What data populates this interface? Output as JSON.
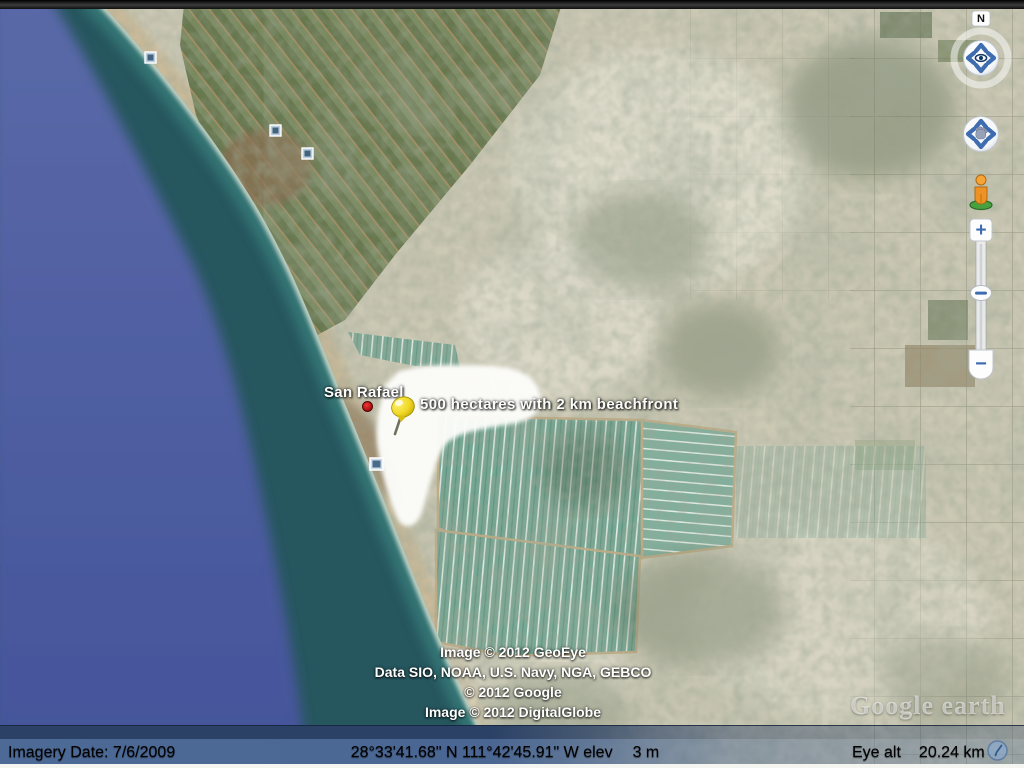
{
  "map": {
    "place": {
      "label": "San Rafael"
    },
    "property": {
      "label": "500 hectares with 2 km beachfront"
    },
    "attribution": [
      "Image © 2012 GeoEye",
      "Data SIO, NOAA, U.S. Navy, NGA, GEBCO",
      "© 2012 Google",
      "Image © 2012 DigitalGlobe"
    ],
    "watermark": "Google earth"
  },
  "controls": {
    "north_indicator": "N",
    "zoom_in": "+",
    "zoom_out": "−",
    "look_icon": "eye-icon",
    "pan_icon": "hand-icon",
    "street_view_icon": "pegman-icon",
    "photo_icon": "photo-placemark-icon",
    "streaming_icon": "spinner-icon"
  },
  "status_bar": {
    "imagery_date": "Imagery Date: 7/6/2009",
    "coordinates": "28°33'41.68\" N 111°42'45.91\" W elev",
    "elevation": "3 m",
    "eye_alt_label": "Eye alt",
    "eye_alt_value": "20.24 km"
  },
  "colors": {
    "ocean_deep": "#5062a2",
    "ocean_shallow": "#26565e",
    "surf_turquoise": "#3f8c86",
    "beach_sand": "#c9b897",
    "desert": "#cbc8b4",
    "fields_olive": "#6f7f57",
    "fields_teal": "#74a694",
    "statusbar_blue": "#4a6692",
    "accent_blue": "#3e6cb0",
    "pushpin_yellow": "#f5e13a",
    "placemark_red": "#c11414"
  }
}
